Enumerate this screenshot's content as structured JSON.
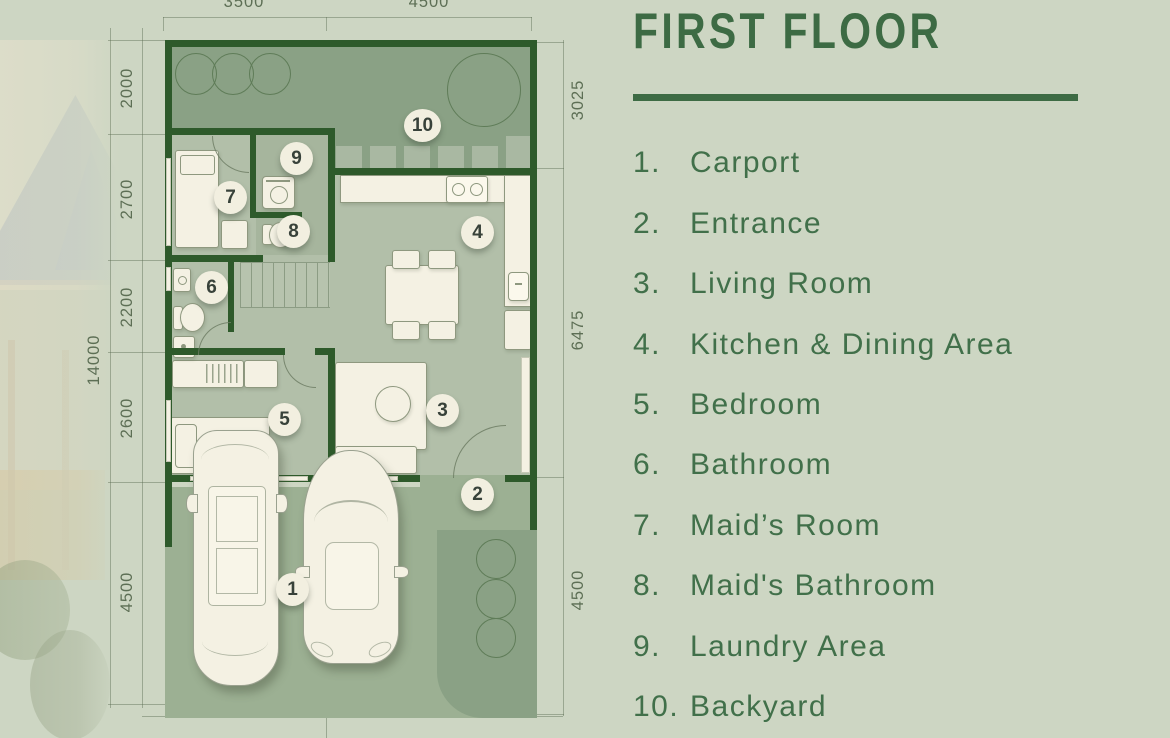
{
  "theme": {
    "bg": "#cdd6c3",
    "accent": "#3d6b44",
    "wall": "#2e5a2b",
    "yard": "#8aa185",
    "floor": "#b2bfa9",
    "paving": "#9cb093",
    "cream": "#f4f1e3",
    "outline": "#8e987f",
    "dim": "#5d6f55",
    "badge_bg": "#f2efe0",
    "badge_text": "#38423a"
  },
  "legend": {
    "title": "FIRST FLOOR",
    "items": [
      {
        "num": "1.",
        "label": "Carport"
      },
      {
        "num": "2.",
        "label": "Entrance"
      },
      {
        "num": "3.",
        "label": "Living Room"
      },
      {
        "num": "4.",
        "label": "Kitchen & Dining Area"
      },
      {
        "num": "5.",
        "label": "Bedroom"
      },
      {
        "num": "6.",
        "label": "Bathroom"
      },
      {
        "num": "7.",
        "label": "Maid’s Room"
      },
      {
        "num": "8.",
        "label": "Maid's Bathroom"
      },
      {
        "num": "9.",
        "label": "Laundry Area"
      },
      {
        "num": "10.",
        "label": "Backyard"
      }
    ]
  },
  "plan": {
    "room_badges": [
      "1",
      "2",
      "3",
      "4",
      "5",
      "6",
      "7",
      "8",
      "9",
      "10"
    ],
    "dimensions": {
      "top": [
        "3500",
        "4500"
      ],
      "left_segments": [
        "2000",
        "2700",
        "2200",
        "2600",
        "4500"
      ],
      "left_total": "14000",
      "right_segments": [
        "3025",
        "6475",
        "4500"
      ]
    }
  }
}
